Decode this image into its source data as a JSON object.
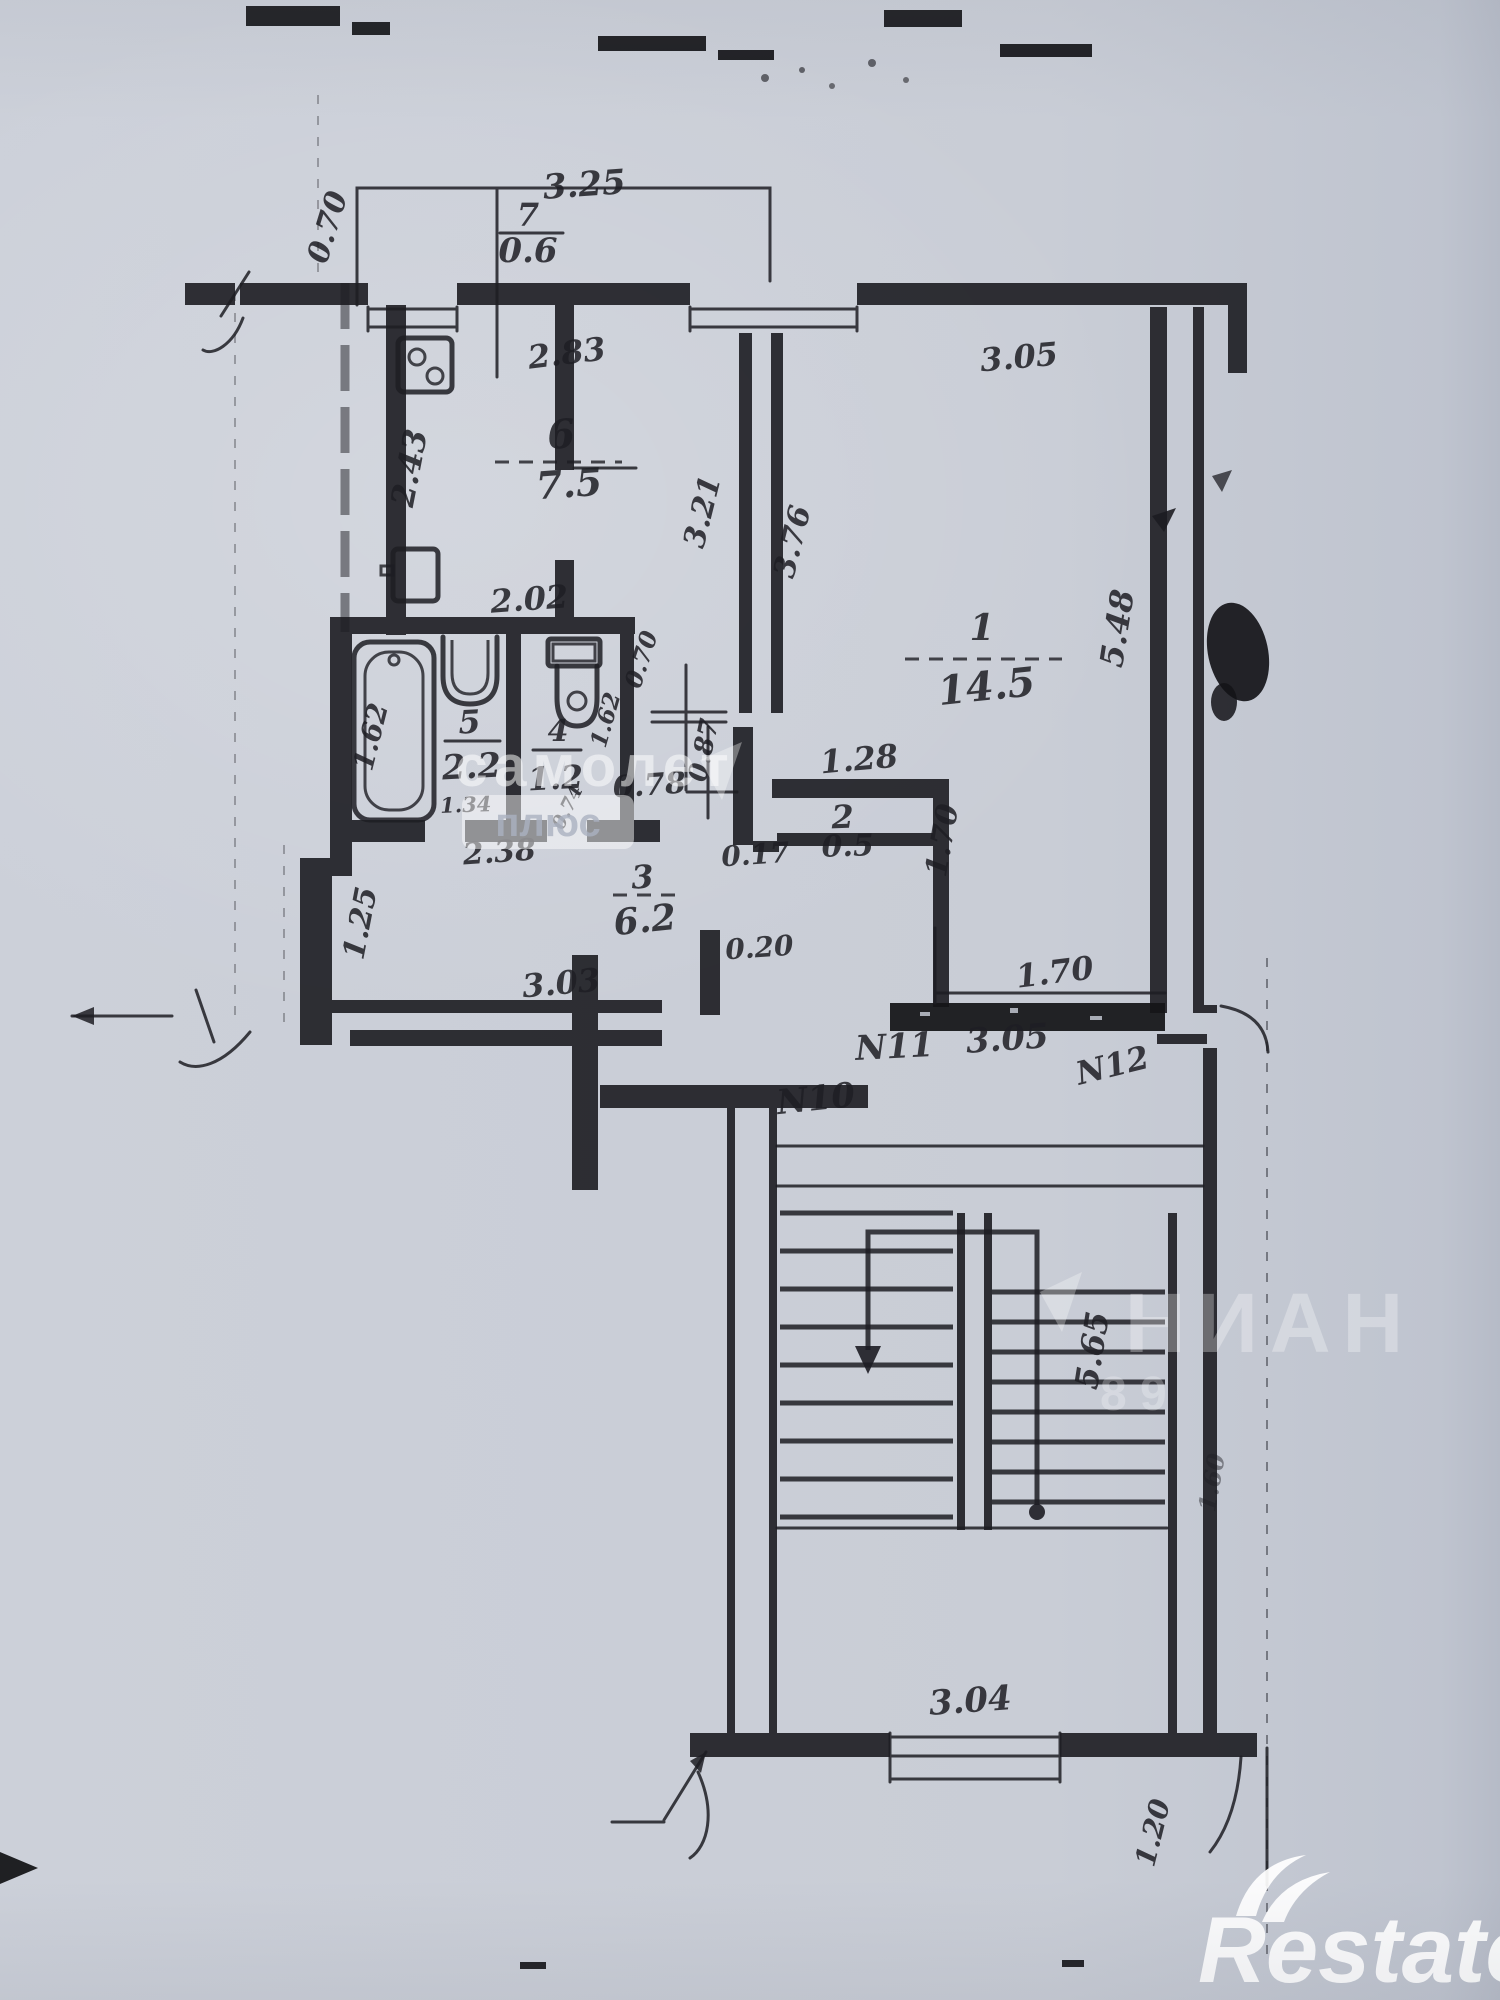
{
  "labels": {
    "balcony_width": "3.25",
    "balcony_depth": "0.70",
    "balcony_num": "7",
    "balcony_area": "0.6",
    "kitchen_num": "6",
    "kitchen_area": "7.5",
    "kitchen_window": "2.83",
    "kitchen_height": "2.43",
    "kitchen_width": "2.02",
    "corridor_wall": "3.21",
    "room1_wall_left": "3.76",
    "room1_top": "3.05",
    "room1_num": "1",
    "room1_area": "14.5",
    "room1_right": "5.48",
    "bath_len": "1.62",
    "bath_num": "5",
    "bath_area": "2.2",
    "bath_width": "1.34",
    "wc_num": "4",
    "wc_area": "1.2",
    "wc_sub": "0.74",
    "wc_len": "1.62",
    "wc_door": "0.70",
    "corridor_a": "0.87",
    "hall_door": "0.78",
    "closet_step": "0.17",
    "closet_top": "1.28",
    "closet_num": "2",
    "closet_area": "0.5",
    "closet_right": "1.70",
    "hall_top": "2.38",
    "hall_num": "3",
    "hall_area": "6.2",
    "hall_left": "1.25",
    "hall_bottom": "3.03",
    "landing_door": "0.20",
    "apt11": "N11",
    "landing_width": "3.05",
    "sill_width": "1.70",
    "apt10": "N10",
    "apt12": "N12",
    "stair_flight": "5.65",
    "stair_bottom": "3.04",
    "entry_side": "1.20",
    "stair_right": "1.60"
  },
  "watermarks": {
    "center_line1": "самолет",
    "center_line2": "плюс",
    "bottom_line1": "НИАН",
    "bottom_line2": "8 9",
    "brand": "Restate"
  }
}
